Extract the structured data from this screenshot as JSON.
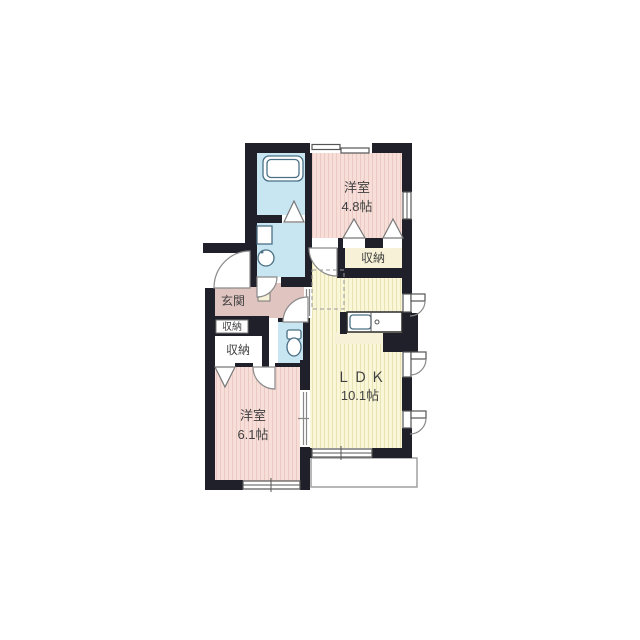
{
  "plan": {
    "rooms": {
      "western_room_1": {
        "label": "洋室",
        "size": "4.8帖"
      },
      "closet_upper": {
        "label": "収納"
      },
      "entrance": {
        "label": "玄関"
      },
      "closet_entrance": {
        "label": "収納"
      },
      "closet_lower": {
        "label": "収納"
      },
      "western_room_2": {
        "label": "洋室",
        "size": "6.1帖"
      },
      "ldk": {
        "label": "ＬＤＫ",
        "size": "10.1帖"
      }
    },
    "fixtures": [
      "bathtub-icon",
      "washbasin-icon",
      "toilet-icon",
      "kitchen-sink-icon",
      "washer-pan-icon"
    ]
  },
  "palette": {
    "wall": "#20202a",
    "room_pink": "#f7ded9",
    "room_pink_stripe": "#eccac4",
    "room_yellow": "#faf7d9",
    "room_yellow_stripe": "#e9e2b4",
    "hall_mauve": "#e0c4c0",
    "wet_cyan": "#c8e5f2",
    "closet_cream": "#f6f1d7",
    "fixture_stroke": "#4a6f85",
    "door_stroke": "#8a8a8a",
    "balcony_stroke": "#9a9a9a",
    "text": "#3f3f3f"
  }
}
